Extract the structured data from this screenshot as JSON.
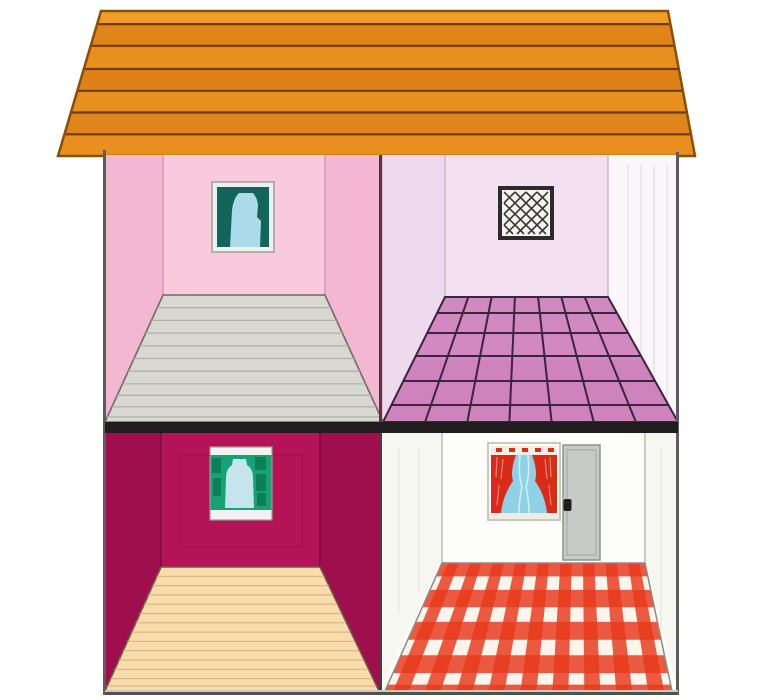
{
  "scene": {
    "description": "dollhouse cross-section illustration with four rooms and an orange plank roof",
    "background": "#ffffff"
  },
  "roof": {
    "outline": "#8a4e07",
    "plank_line": "#6f3d05",
    "plank_colors": [
      "#ef9c2a",
      "#e0851a",
      "#e78f1f",
      "#de8218",
      "#e78f1f",
      "#e0851a",
      "#e88f20"
    ]
  },
  "frame": {
    "divider_color": "#211c1e",
    "outer_wall_color": "#5f5a5c",
    "center_wall_color": "#453f42",
    "base_top": "#c9c9c4",
    "base_bottom": "#55504e"
  },
  "rooms": {
    "top_left": {
      "wall": "#f9c9dc",
      "side_wall": "#f4b7d1",
      "corner_line": "#d898ba",
      "floor": "#d9d7d1",
      "floor_line": "#b2b0aa",
      "floor_edge": "#6e6a66",
      "window": {
        "frame": "#eef0ee",
        "frame_line": "#9aa0a0",
        "glass": "#13655c",
        "curtain": "#abdae8"
      }
    },
    "top_right": {
      "wall": "#f3e1f2",
      "left_wall": "#eedaee",
      "right_wall": "#faf6fa",
      "right_wall_stripe": "#e6dde6",
      "corner_line": "#cdb6cd",
      "tile": "#ce83bc",
      "tile_sheen": "#d994c7",
      "grout": "#3a2440",
      "window": {
        "frame": "#2b2b2b",
        "glass": "#f5f3ee",
        "lattice": "#3a3a3a"
      }
    },
    "bottom_left": {
      "wall": "#b31458",
      "side_wall": "#a00f4d",
      "corner_line": "#7c0a3e",
      "panel_line": "#930d49",
      "floor": "#f8dcab",
      "floor_line": "#e0b183",
      "floor_edge": "#6e5a46",
      "window": {
        "frame": "#f2f2f0",
        "frame_line": "#9a9a98",
        "glass": "#16a273",
        "glass_dark": "#0c7a53",
        "curtain": "#c6e4eb"
      }
    },
    "bottom_right": {
      "wall": "#fdfdfa",
      "side_wall": "#f7f7f1",
      "wall_stripe": "#e8e8e0",
      "corner_line": "#bdbdb4",
      "floor_base": "#fdf5ec",
      "floor_edge": "#8c8c84",
      "check": "#e8391b",
      "window": {
        "frame": "#c9c9c0",
        "valance": "#f3efe6",
        "sky": "#8fd2e8",
        "curtain": "#d92b18",
        "curtain_fold": "#eaf6fa",
        "sill": "#efece2"
      },
      "door": {
        "fill": "#c7cbc7",
        "border": "#8f938f",
        "panel_line": "#a9ada8",
        "knob": "#1f1f1f"
      }
    }
  }
}
